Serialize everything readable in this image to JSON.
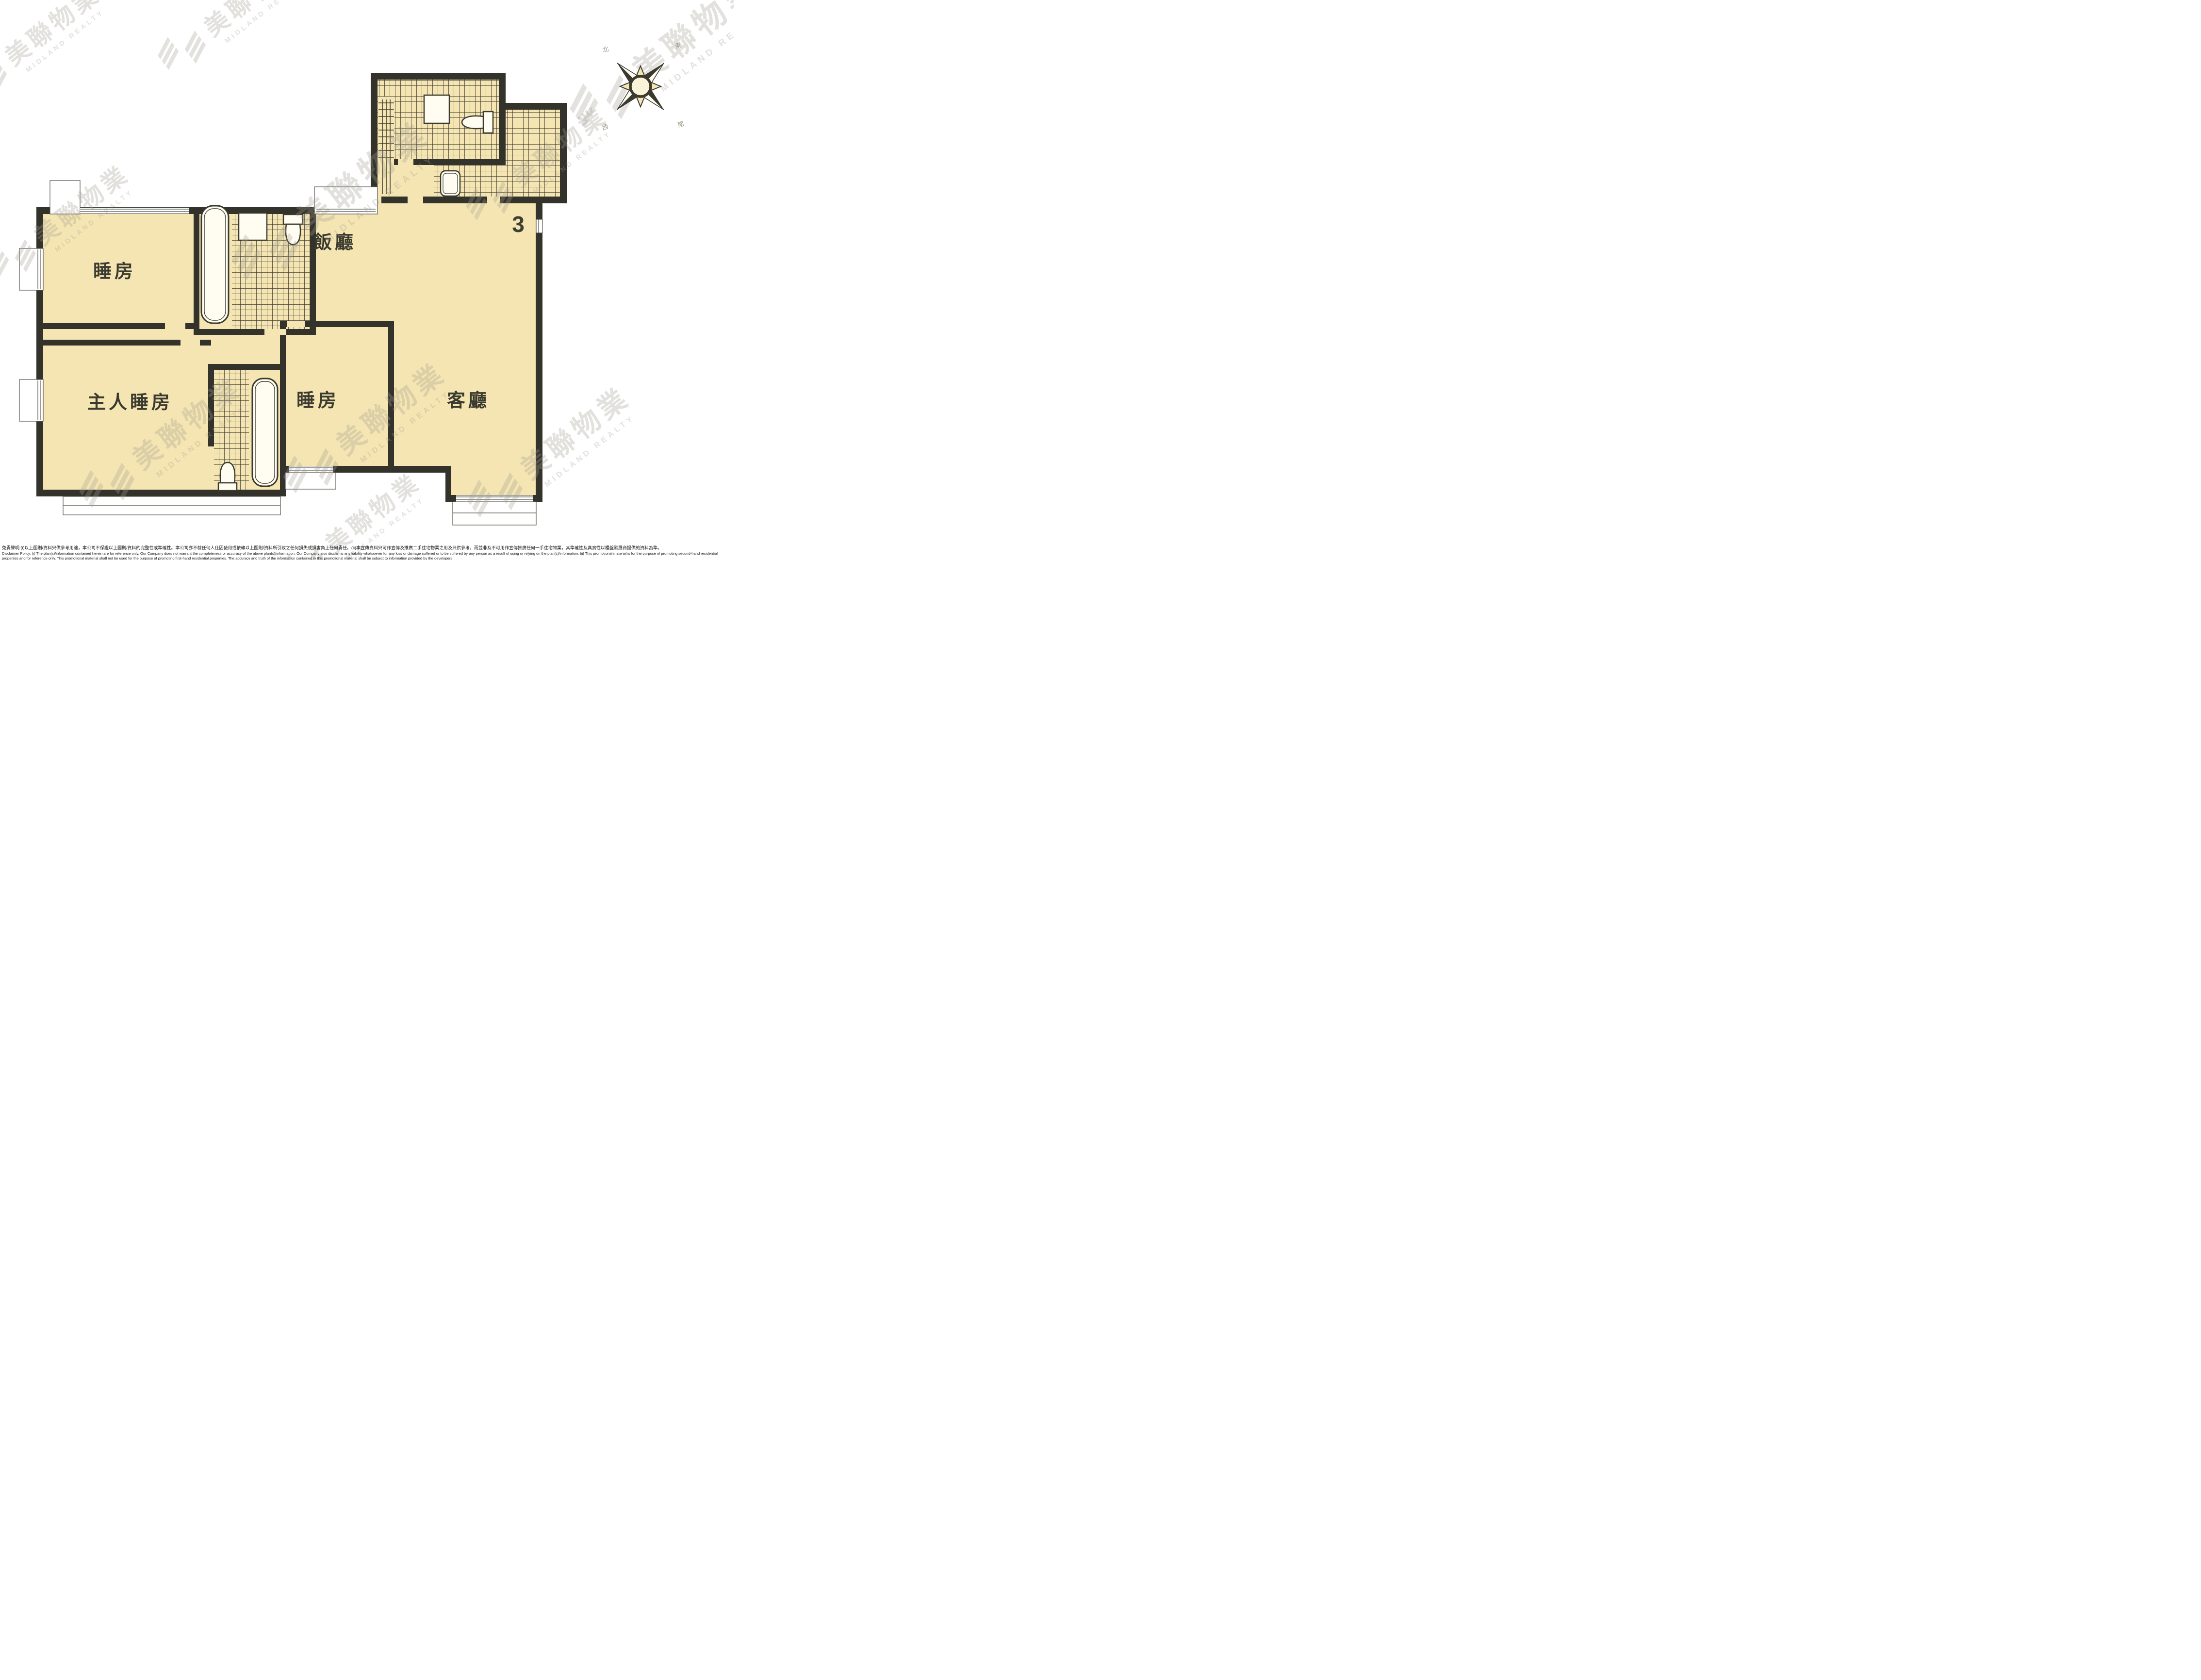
{
  "plan": {
    "unit_number": "3",
    "rooms": [
      {
        "id": "bedroom-1",
        "label": "睡房"
      },
      {
        "id": "dining-room",
        "label": "飯廳"
      },
      {
        "id": "master-bedroom",
        "label": "主人睡房"
      },
      {
        "id": "bedroom-2",
        "label": "睡房"
      },
      {
        "id": "living-room",
        "label": "客廳"
      }
    ],
    "colors": {
      "floor": "#f4e5b2",
      "wall": "#33332b",
      "tile_line": "#3e3c31",
      "thin_line": "#55544a",
      "watermark": "#a39e93",
      "label_text": "#3b3a2f"
    }
  },
  "compass": {
    "labels": {
      "nw": "北",
      "ne": "東",
      "se": "南",
      "sw": "西"
    }
  },
  "watermark": {
    "cn": "美聯物業",
    "en": "MIDLAND REALTY"
  },
  "disclaimer": {
    "zh": "免責聲明:(i)以上圖則/資料只供參考用途，本公司不保證以上圖則/資料的完整性或準確性。本公司亦不就任何人仕因使用或依賴以上圖則/資料所引致之任何損失或損害負上任何責任。(ii)本宣傳資料只可作宣傳及推廣二手住宅物業之用及只供參考，而並非及不可用作宣傳推廣任何一手住宅物業，其準確性及真實性以樓盤發展商提供的資料為準。",
    "en": "Disclaimer Policy: (i) The plan(s)/information contained herein are for reference only. Our Company does not warrant the completeness or accuracy of the above plan(s)/information. Our Company also disclaims any liability whatsoever for any loss or damage suffered or to be suffered by any person as a result of using or relying on the plan(s)/information. (ii) This promotional material is for the purpose of promoting second-hand residential properties and for reference only. This promotional material shall not be used for the purpose of promoting first-hand residential properties. The accuracy and truth of the information contained in this promotional material shall be subject to information provided by the developers."
  }
}
